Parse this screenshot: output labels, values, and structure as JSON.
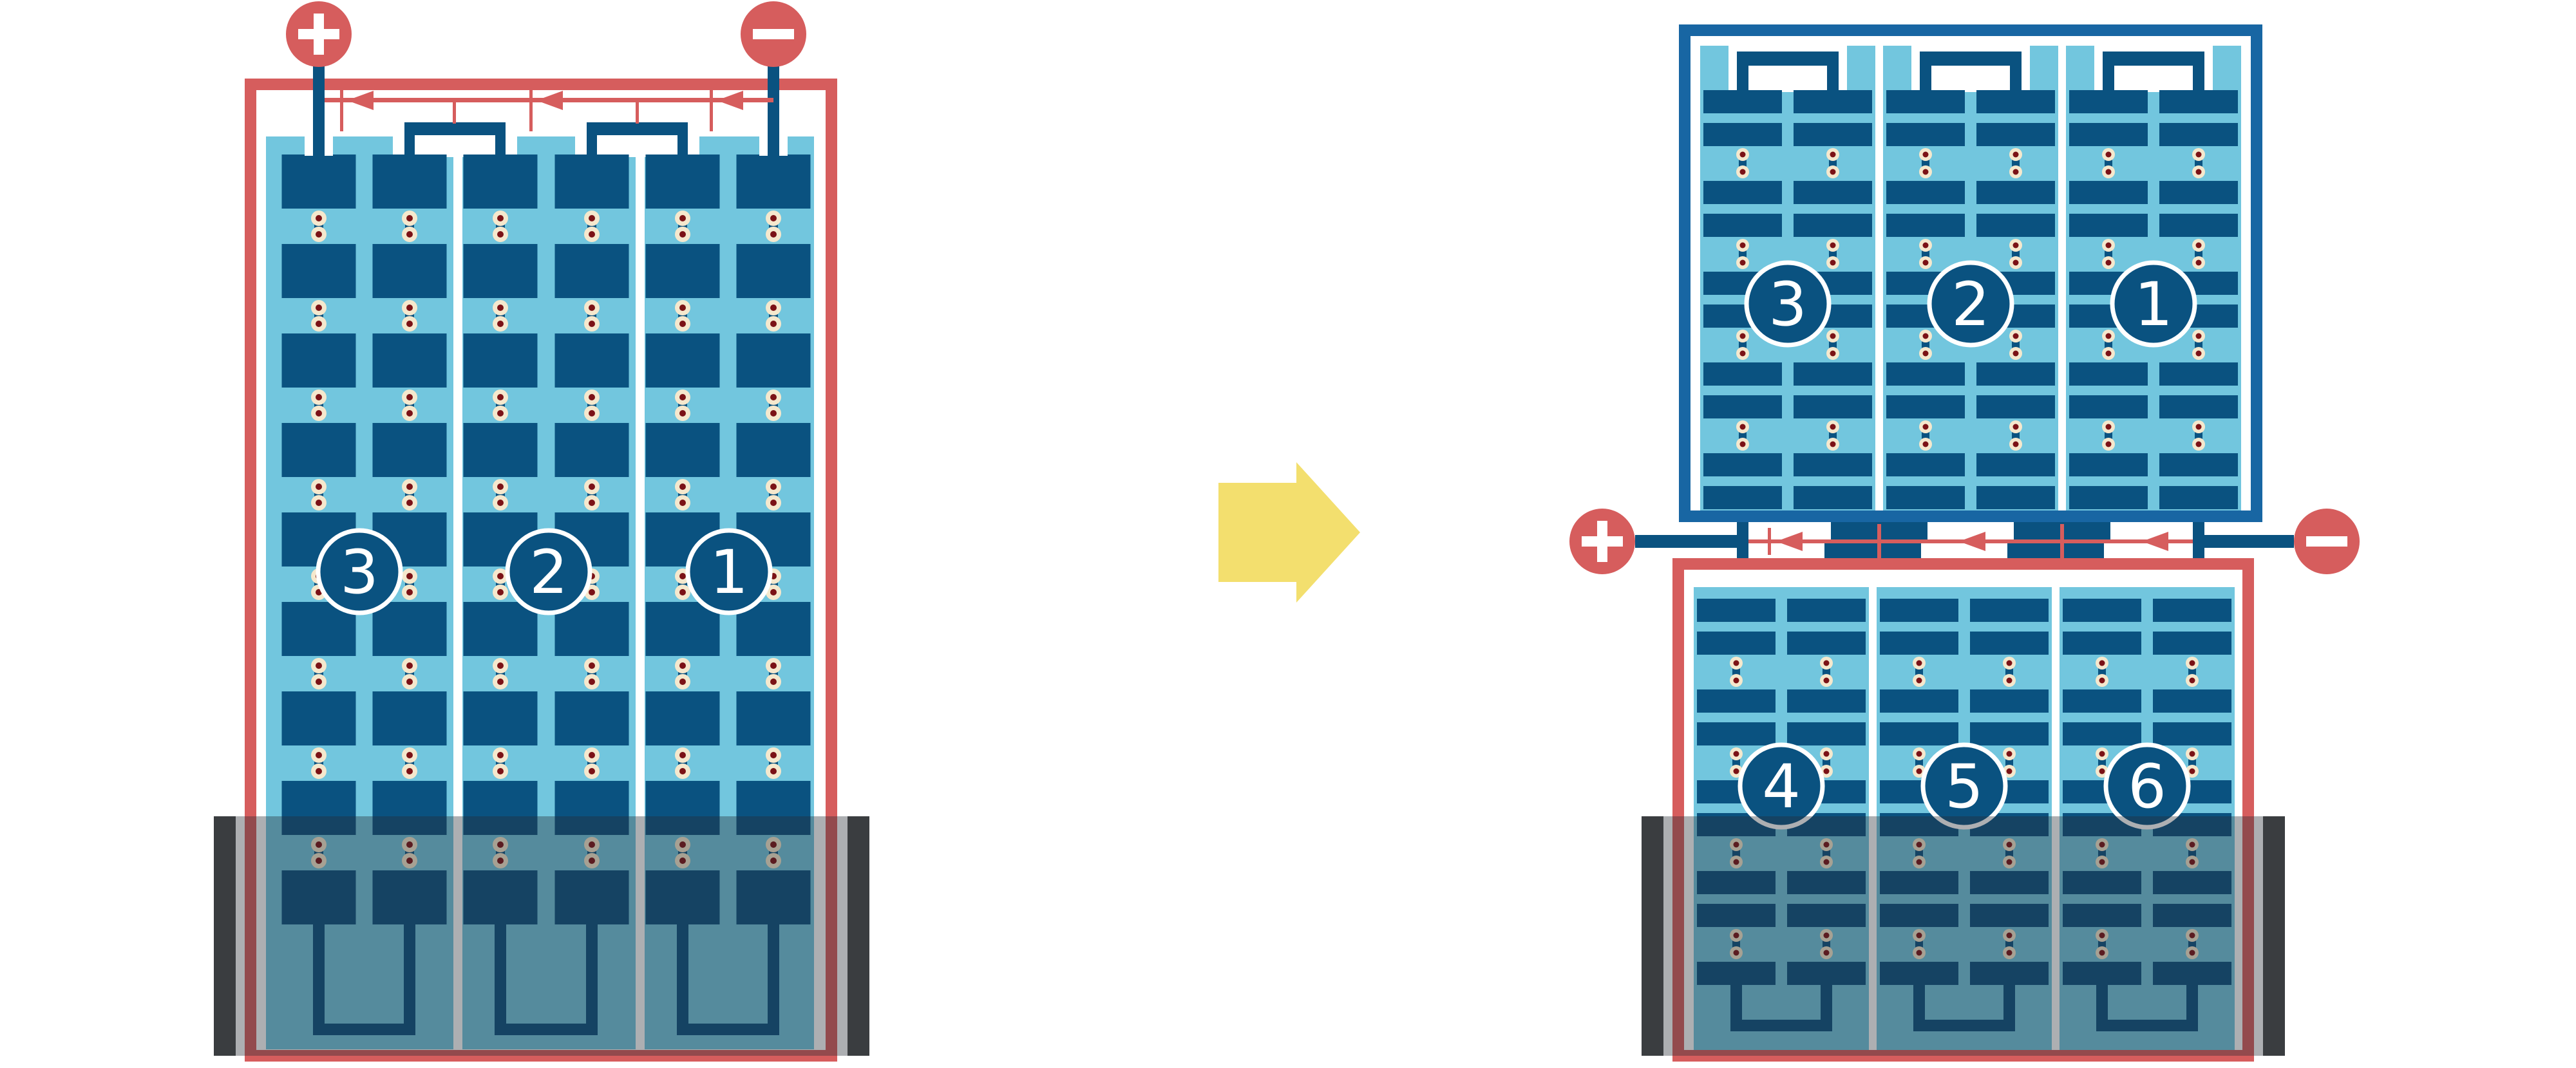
{
  "diagram": {
    "title": "battery-series-rewiring-diagram",
    "colors": {
      "background": "#FFFFFF",
      "case_red": "#D65D5D",
      "case_blue": "#1866A3",
      "plate_blue": "#0A5280",
      "electrolyte_blue": "#72C6DE",
      "rivet_outer": "#F5E8CD",
      "rivet_inner": "#7B1216",
      "flow_red": "#D65D5D",
      "transform_yellow": "#F3DF6E",
      "tray_overlay": "rgba(40,46,52,0.38)",
      "tray_cap": "#3A3D40",
      "divider_white": "#FFFFFF",
      "number_text": "#FFFFFF"
    },
    "left_battery": {
      "cell_labels": [
        "3",
        "2",
        "1"
      ],
      "plate_rows": 9,
      "positive_symbol": "+",
      "negative_symbol": "−"
    },
    "right_top_battery": {
      "cell_labels": [
        "3",
        "2",
        "1"
      ],
      "plate_rows": 10
    },
    "right_bottom_battery": {
      "cell_labels": [
        "4",
        "5",
        "6"
      ],
      "plate_rows": 9
    },
    "right_terminals": {
      "positive_symbol": "+",
      "negative_symbol": "−"
    }
  }
}
